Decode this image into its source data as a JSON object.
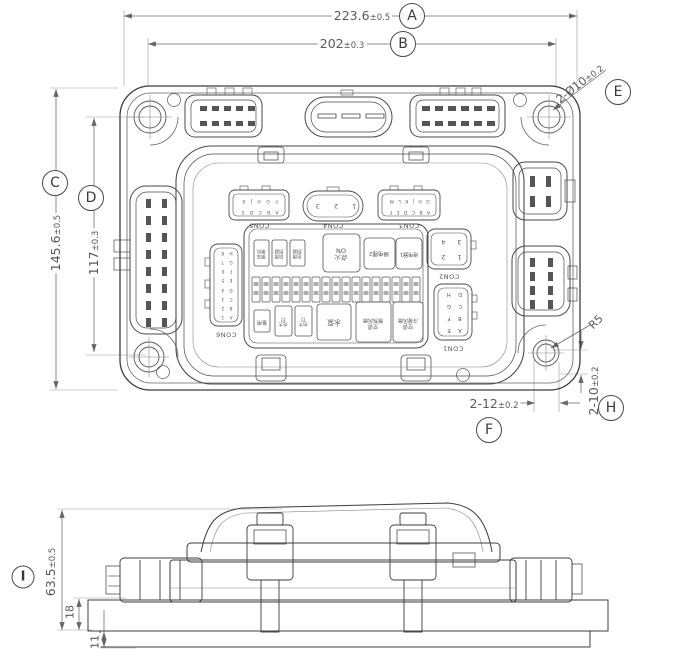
{
  "dims": {
    "A": {
      "balloon": "A",
      "text": "223.6",
      "tol": "±0.5"
    },
    "B": {
      "balloon": "B",
      "text": "202",
      "tol": "±0.3"
    },
    "C": {
      "balloon": "C",
      "text": "145.6",
      "tol": "±0.5"
    },
    "D": {
      "balloon": "D",
      "text": "117",
      "tol": "±0.3"
    },
    "E": {
      "balloon": "E",
      "text": "2-Ø10",
      "tol": "±0.2"
    },
    "F": {
      "balloon": "F",
      "text": "2-12",
      "tol": "±0.2"
    },
    "H": {
      "balloon": "H",
      "text": "2-10",
      "tol": "±0.2"
    },
    "I": {
      "balloon": "I",
      "text": "63.5",
      "tol": "±0.5"
    },
    "R": {
      "text": "R5"
    },
    "d18": {
      "text": "18"
    },
    "d11": {
      "text": "11"
    }
  },
  "connectors": {
    "con5": {
      "label": "CON5",
      "row1": "A B C D E",
      "row2": "F G H J K"
    },
    "con4": {
      "label": "CON4",
      "row1": "1   2   3"
    },
    "con3": {
      "label": "CON3",
      "row1": "A B C D E F",
      "row2": "G H J K L M"
    },
    "con2": {
      "label": "CON2",
      "row1": "1  2",
      "row2": "3  4"
    },
    "con1": {
      "label": "CON1",
      "rows": [
        "A E",
        "B F",
        "C G",
        "D H"
      ]
    },
    "con6": {
      "label": "CON6",
      "rows": [
        "A 1",
        "B 2",
        "C 3",
        "D 4",
        "E 5",
        "F 6",
        "G 7",
        "H 8"
      ]
    }
  },
  "panel": {
    "ignition_line1": "点火",
    "ignition_line2": "ON",
    "relay1": "继电器1",
    "relay2": "继电器2",
    "pump": "水泵",
    "spare": "备用",
    "top_small": [
      {
        "l1": "倒车",
        "l2": "喇叭"
      },
      {
        "l1": "前雨",
        "l2": "刮器"
      },
      {
        "l1": "后雨",
        "l2": "刮器"
      }
    ],
    "bottom_small": [
      {
        "l1": "左大",
        "l2": "灯"
      },
      {
        "l1": "右大",
        "l2": "灯"
      }
    ],
    "ac1_line1": "空调",
    "ac1_line2": "散热风扇",
    "ac2_line1": "空调",
    "ac2_line2": "冷凝风扇"
  }
}
